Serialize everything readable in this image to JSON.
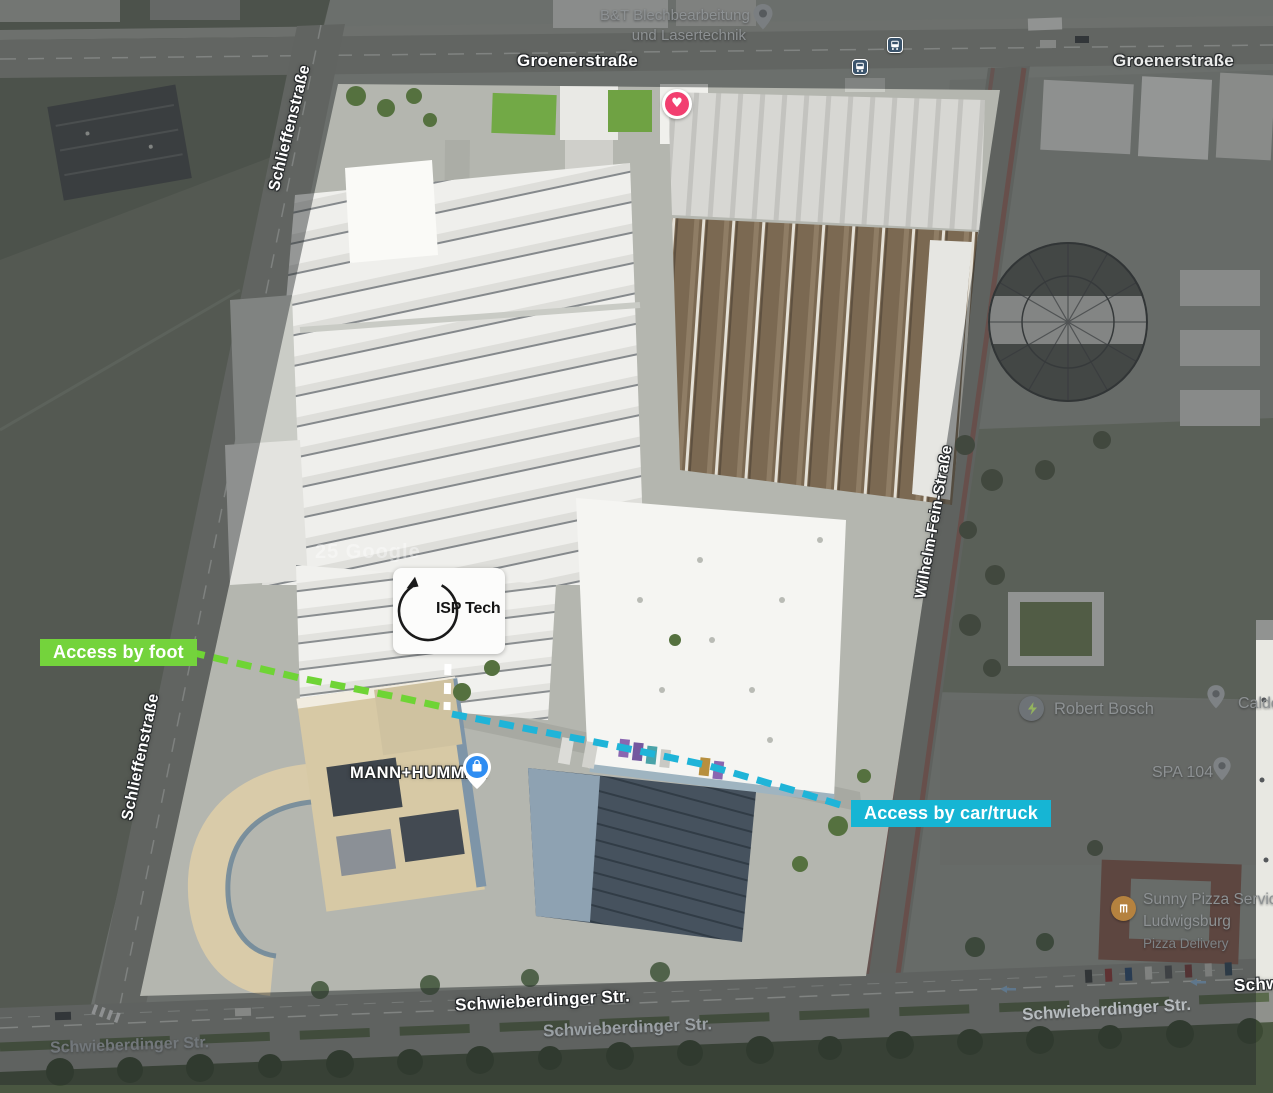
{
  "map_overlay": {
    "access_by_foot": "Access by foot",
    "access_by_car": "Access by car/truck",
    "logo": "ISP Tech"
  },
  "street_labels": {
    "groener_center": "Groenerstraße",
    "groener_right": "Groenerstraße",
    "schlieffen_top": "Schlieffenstraße",
    "schlieffen_bottom": "Schlieffenstraße",
    "wilhelm_fein": "Wilhelm-Fein-Straße",
    "schwieberdinger_main": "Schwieberdinger Str.",
    "schwieberdinger_dim_center": "Schwieberdinger Str.",
    "schwieberdinger_dim_left": "Schwieberdinger Str.",
    "schwieberdinger_dim_right": "Schwieberdinger Str.",
    "schwieberdinger_clipped": "Schw"
  },
  "poi_labels": {
    "bt_line1": "B&T Blechbearbeitung",
    "bt_line2": "und Lasertechnik",
    "mann_hummel": "MANN+HUMMEL",
    "robert_bosch": "Robert Bosch",
    "spa_104": "SPA 104",
    "calde_clipped": "Calde",
    "pizza_line1": "Sunny Pizza Service",
    "pizza_line2": "Ludwigsburg",
    "pizza_subtitle": "Pizza Delivery"
  },
  "watermark": "25 Google",
  "icons": {
    "heart_marker": "heart",
    "heart_glyph": "♥",
    "transit_stop": "bus",
    "mann_hummel_marker": "shopping-bag",
    "robert_bosch_marker": "ev-charging-lightning",
    "spa_104_marker": "map-pin",
    "calde_marker": "map-pin",
    "bt_marker": "map-pin",
    "pizza_marker": "fork-and-knife",
    "logo_mark": "circular-arrow"
  },
  "colors": {
    "access_foot_bg": "#74d33c",
    "access_car_bg": "#16b5d4",
    "route_foot_dash": "#6fd435",
    "route_car_dash": "#1fb4d8",
    "route_connector_dash": "#ffffff",
    "heart_marker": "#f23f70",
    "poi_marker_blue": "#2e8df2",
    "transit_icon_bg": "#3a536b"
  }
}
